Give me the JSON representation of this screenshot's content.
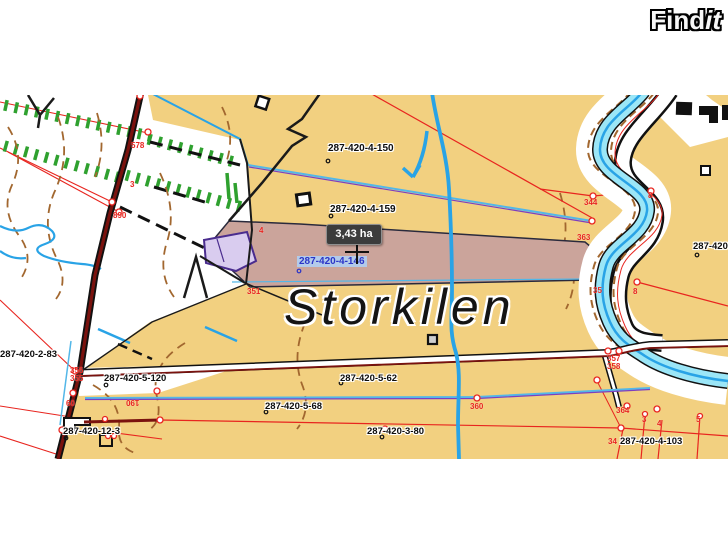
{
  "header": {
    "logo_find": "Find",
    "logo_it": "it"
  },
  "map": {
    "place_name": "Storkilen",
    "area_tooltip": "3,43 ha",
    "selected_parcel": "287-420-4-146",
    "parcels": {
      "p150": "287-420-4-150",
      "p159": "287-420-4-159",
      "p283": "287-420-2-83",
      "p5120": "287-420-5-120",
      "p562": "287-420-5-62",
      "p568": "287-420-5-68",
      "p380": "287-420-3-80",
      "p123": "287-420-12-3",
      "p4103": "287-420-4-103",
      "pedge": "287-420-"
    },
    "ticks": {
      "t3": "3",
      "t890": "890",
      "t578": "578",
      "t4": "4",
      "t351": "351",
      "t356": "356",
      "t355": "355",
      "t60": "60",
      "t190": "190",
      "t360": "360",
      "t344": "344",
      "t363": "363",
      "t35": "35",
      "t8": "8",
      "t357": "357",
      "t358": "358",
      "t364": "364",
      "tb3": "3",
      "tb4": "4",
      "tb5": "5",
      "t34": "34"
    },
    "colors": {
      "land": "#F2D080",
      "selected_parcel_fill": "#CBA49B",
      "water_fill": "#9BE6F7",
      "water_line": "#29A3E6",
      "contour": "#A2672F",
      "cadastral_red": "#E8251F",
      "hatch_green": "#2FA12F",
      "lavender_parcel": "#D9CCEF",
      "road_core": "#7A120E"
    }
  }
}
